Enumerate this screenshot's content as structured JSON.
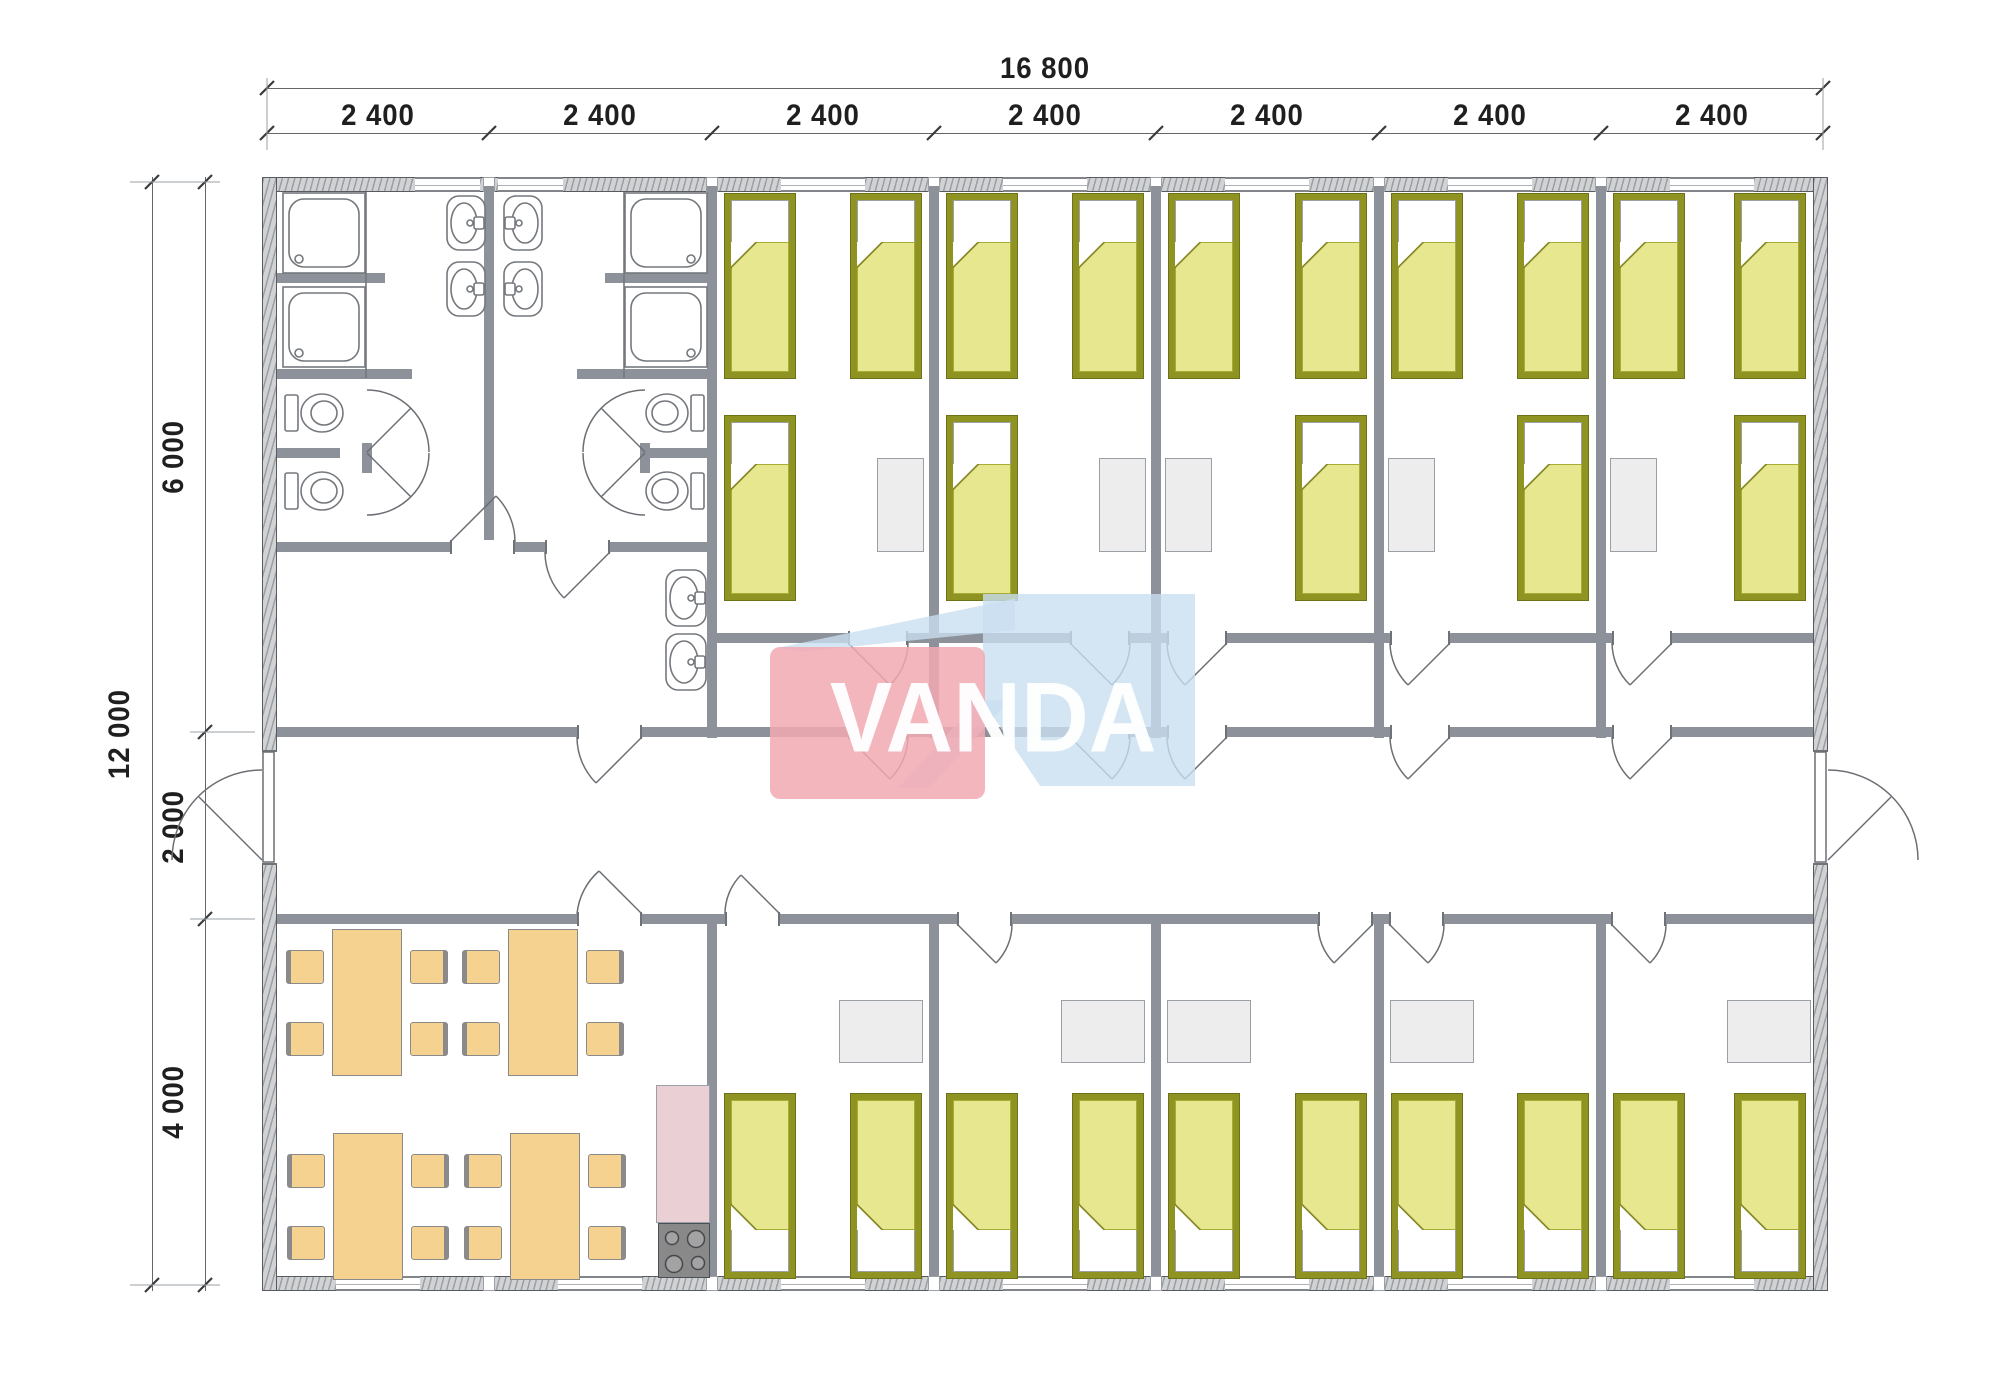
{
  "drawing": {
    "type": "architectural floor plan",
    "building": "modular dormitory, 7 container modules",
    "logo": {
      "text": "VANDA"
    }
  },
  "dimensions": {
    "top_total": "16 800",
    "top_segments": [
      "2 400",
      "2 400",
      "2 400",
      "2 400",
      "2 400",
      "2 400",
      "2 400"
    ],
    "side_total": "12 000",
    "side_segments": [
      "6 000",
      "2 000",
      "4 000"
    ]
  },
  "colors": {
    "wall": "#8d929a",
    "wall_edge": "#575b60",
    "wallx_fill": "#d0d2d4",
    "wallx_hatch": "#9b9ea3",
    "bed_frame": "#8e9321",
    "bed_trim": "#a9ac35",
    "bed_fill": "#e6e78f",
    "desk": "#ededee",
    "desk_edge": "#9aa0a6",
    "dining": "#f5d28f",
    "dining_edge": "#8a8a8a",
    "counter": "#eacfd4",
    "stove": "#898989",
    "logo_pink": "#f2a9b1",
    "logo_blue": "#c9dff0",
    "dim": "#1f1f1f",
    "line": "#666666",
    "fix": "#6b6f74"
  }
}
